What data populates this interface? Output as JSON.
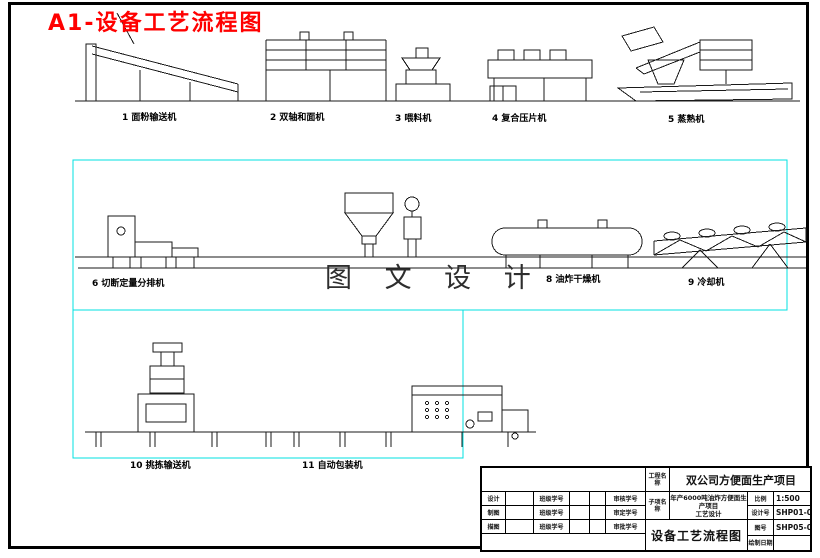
{
  "page_title": "A1-设备工艺流程图",
  "watermark": "图 文 设 计",
  "colors": {
    "accent_red": "#ff0000",
    "cyan_frame": "#00e0e0",
    "line_black": "#1a1a1a"
  },
  "machines": [
    {
      "label": "1 面粉输送机"
    },
    {
      "label": "2 双轴和面机"
    },
    {
      "label": "3 喂料机"
    },
    {
      "label": "4 复合压片机"
    },
    {
      "label": "5 蒸熟机"
    },
    {
      "label": "6 切断定量分排机"
    },
    {
      "label": "8 油炸干燥机"
    },
    {
      "label": "9 冷却机"
    },
    {
      "label": "10 挑拣输送机"
    },
    {
      "label": "11 自动包装机"
    }
  ],
  "title_block": {
    "project_label": "工程名称",
    "project_name": "双公司方便面生产项目",
    "sub_item_label": "子项名称",
    "sub_item_line1": "年产6000吨油炸方便面生产项目",
    "sub_item_line2": "工艺设计",
    "scale_label": "比例",
    "scale": "1:500",
    "design_no_label": "设计号",
    "design_no": "SHP01-0",
    "drawing_no_label": "图号",
    "drawing_no": "SHP05-0",
    "date_label": "绘制日期",
    "date": "",
    "drawing_title": "设备工艺流程图",
    "sign_rows": [
      {
        "c1": "设计",
        "c2": "班级学号",
        "c3": "审核学号"
      },
      {
        "c1": "制图",
        "c2": "班级学号",
        "c3": "审定学号"
      },
      {
        "c1": "描图",
        "c2": "班级学号",
        "c3": "审批学号"
      }
    ]
  }
}
